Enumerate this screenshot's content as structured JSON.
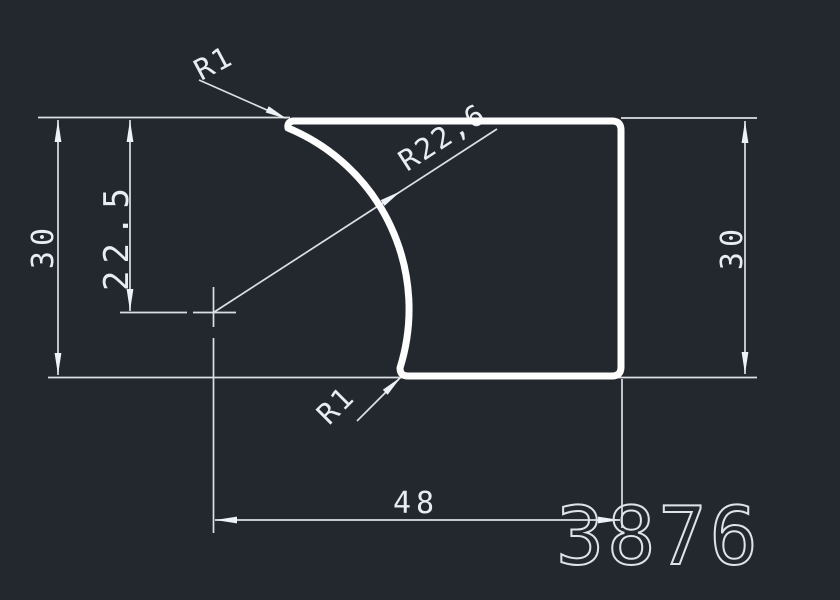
{
  "drawing": {
    "type": "cad-profile-cross-section",
    "part_number": "3876",
    "colors": {
      "background": "#23282e",
      "profile_line": "#fdfdfd",
      "dimension_line": "#dce0e6",
      "text": "#e9edf2"
    },
    "dimensions": {
      "height_left": "30",
      "offset_center": "22.5",
      "height_right": "30",
      "width": "48",
      "fillet_top": "R1",
      "arc_radius": "R22,6",
      "fillet_bottom": "R1"
    }
  }
}
